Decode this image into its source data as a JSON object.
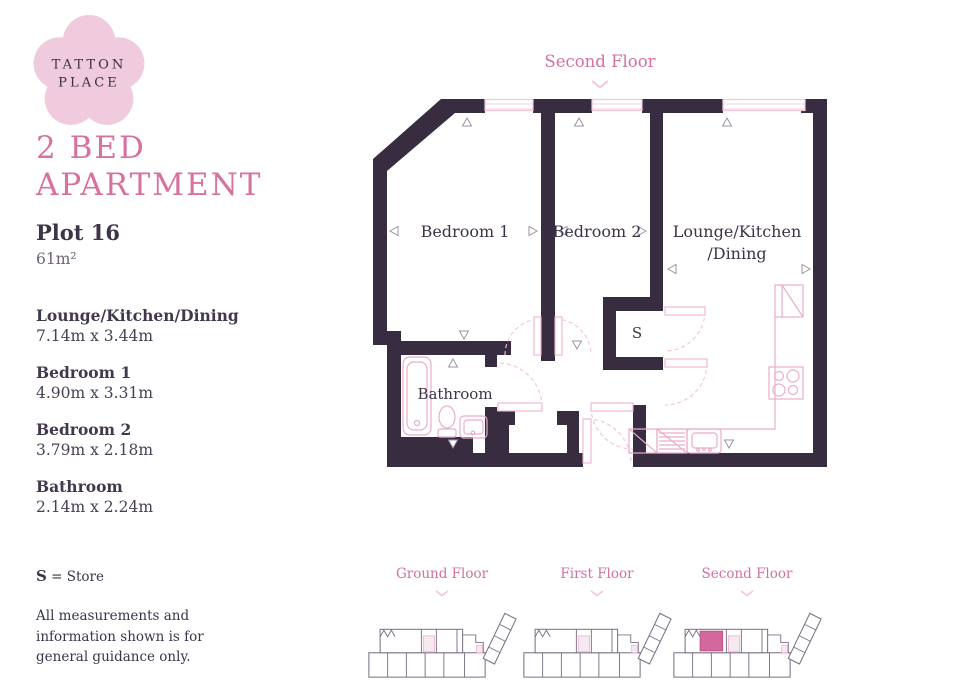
{
  "colors": {
    "wall": "#372C40",
    "accent_pink": "#D4709E",
    "light_pink": "#EFB4CE",
    "logo_pink": "#F0CBDD",
    "highlight_pink": "#D2689B",
    "text_dark": "#473C52"
  },
  "brand": {
    "name_line1": "TATTON",
    "name_line2": "PLACE"
  },
  "listing": {
    "title_line1": "2 BED",
    "title_line2": "APARTMENT",
    "plot": "Plot 16",
    "area": "61m²"
  },
  "rooms": [
    {
      "name": "Lounge/Kitchen/Dining",
      "dimensions": "7.14m x 3.44m"
    },
    {
      "name": "Bedroom 1",
      "dimensions": "4.90m x 3.31m"
    },
    {
      "name": "Bedroom 2",
      "dimensions": "3.79m x 2.18m"
    },
    {
      "name": "Bathroom",
      "dimensions": "2.14m x 2.24m"
    }
  ],
  "legend": {
    "key": "S",
    "rest": "= Store"
  },
  "disclaimer": {
    "line1": "All measurements and",
    "line2": "information shown is for",
    "line3": "general guidance only."
  },
  "floorplan": {
    "title": "Second Floor",
    "labels": {
      "bedroom1": "Bedroom 1",
      "bedroom2": "Bedroom 2",
      "lounge_line1": "Lounge/Kitchen",
      "lounge_line2": "/Dining",
      "bathroom": "Bathroom",
      "store": "S"
    }
  },
  "floor_selector": {
    "options": [
      {
        "label": "Ground Floor"
      },
      {
        "label": "First Floor"
      },
      {
        "label": "Second Floor"
      }
    ],
    "highlighted": "Second Floor"
  }
}
